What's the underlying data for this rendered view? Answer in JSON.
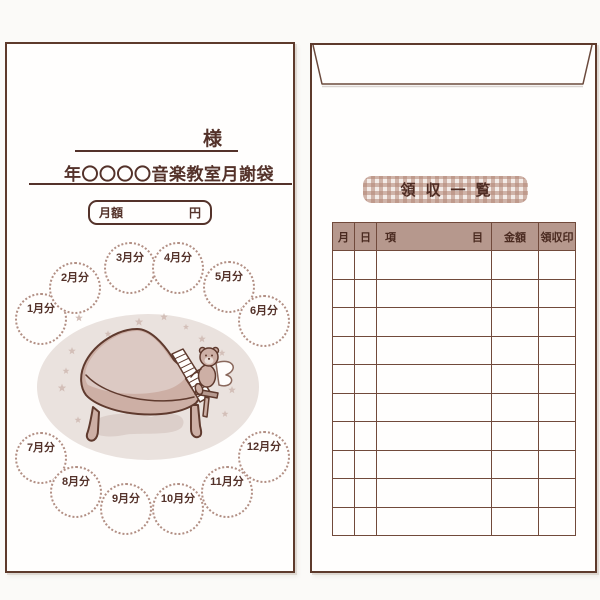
{
  "front_envelope": {
    "name_honorific": "様",
    "title": "年〇〇〇〇音楽教室月謝袋",
    "amount_box": {
      "label": "月額",
      "unit": "円"
    },
    "month_labels": [
      "1月分",
      "2月分",
      "3月分",
      "4月分",
      "5月分",
      "6月分",
      "7月分",
      "8月分",
      "9月分",
      "10月分",
      "11月分",
      "12月分"
    ],
    "illustration_icons": [
      "oval-backdrop",
      "star-icon",
      "grand-piano-icon",
      "teddy-bear-angel-icon",
      "floor-shadow"
    ]
  },
  "back_envelope": {
    "receipt_list_title": "領収一覧",
    "table": {
      "columns": [
        {
          "label": "月"
        },
        {
          "label": "日"
        },
        {
          "label": "項",
          "label_end": "目"
        },
        {
          "label": "金額"
        },
        {
          "label": "領収印"
        }
      ],
      "empty_row_count": 10
    }
  },
  "colors": {
    "outline_brown": "#5e3a2c",
    "text_brown": "#54322a",
    "table_line": "#714a3b",
    "table_header_bg": "#b6988d",
    "dotted_circle": "#b28f84",
    "gingham_check": "#b28575",
    "oval_bg": "#eae2de",
    "star": "#d3bfb8",
    "piano_body": "#cdafa5",
    "piano_lid_light": "#dcc9c3",
    "paper": "#fffefd"
  }
}
